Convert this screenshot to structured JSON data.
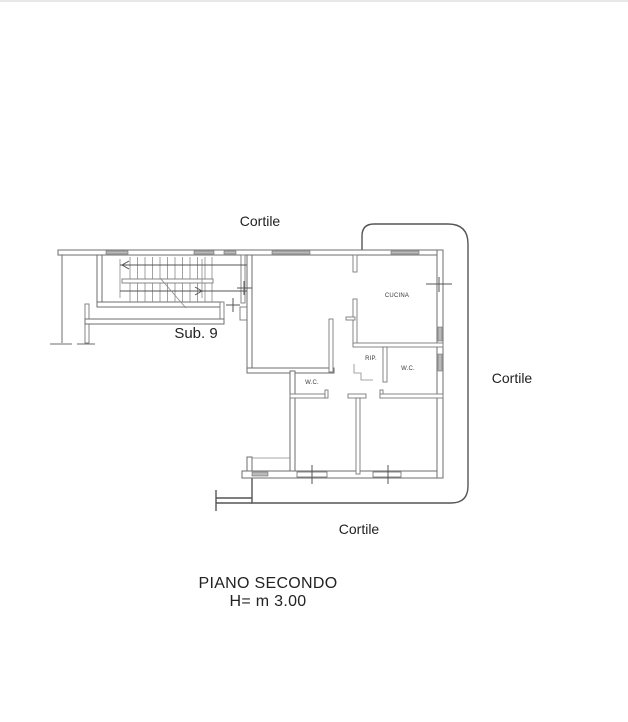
{
  "plan": {
    "areas": {
      "cortile_top": "Cortile",
      "cortile_right": "Cortile",
      "cortile_bottom": "Cortile",
      "sub_unit": "Sub. 9"
    },
    "rooms": {
      "kitchen": "CUCINA",
      "storage": "RIP.",
      "wc_right": "W.C.",
      "wc_left": "W.C."
    },
    "caption": {
      "title": "PIANO SECONDO",
      "height_note": "H= m 3.00"
    },
    "colors": {
      "wall_stroke": "#6e6e6e",
      "courtyard_boundary": "#555555",
      "text": "#222222",
      "window_fill": "#b9b9b9",
      "background": "#ffffff"
    }
  }
}
